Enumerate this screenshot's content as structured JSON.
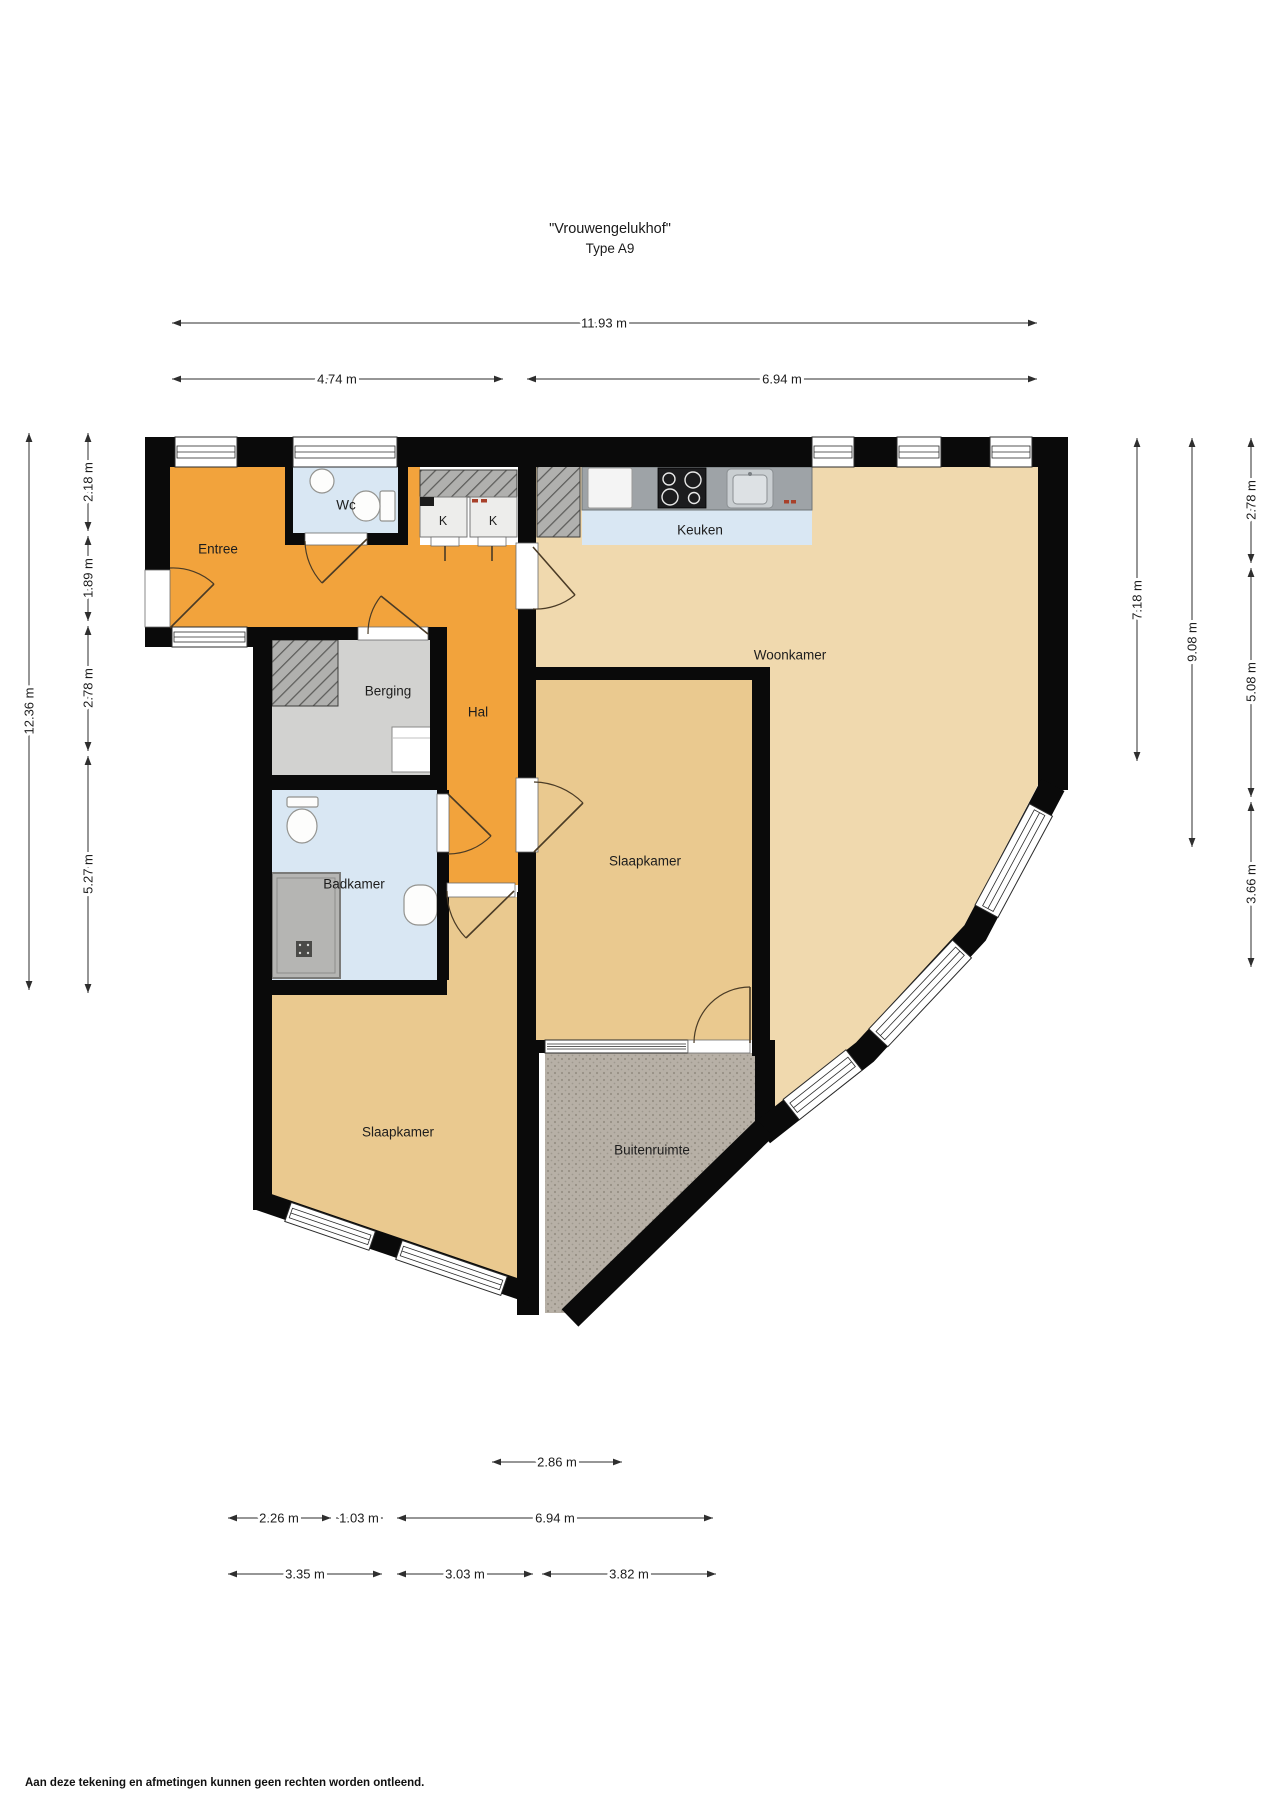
{
  "title": {
    "name": "\"Vrouwengelukhof\"",
    "type": "Type A9"
  },
  "rooms": {
    "entree": "Entree",
    "wc": "Wc",
    "keuken": "Keuken",
    "woonkamer": "Woonkamer",
    "berging": "Berging",
    "hal": "Hal",
    "slaapkamer_middle": "Slaapkamer",
    "badkamer": "Badkamer",
    "slaapkamer_left": "Slaapkamer",
    "buitenruimte": "Buitenruimte",
    "closet_left": "K",
    "closet_right": "K"
  },
  "dimensions": {
    "top": {
      "total": "11.93 m",
      "left_section": "4.74 m",
      "right_section": "6.94 m"
    },
    "left": {
      "total": "12.36 m",
      "segments": [
        "2.18 m",
        "1.89 m",
        "2.78 m",
        "5.27 m"
      ]
    },
    "right": {
      "living_depth": "7.18 m",
      "overall_depth": "9.08 m",
      "segments": [
        "2.78 m",
        "5.08 m",
        "3.66 m"
      ]
    },
    "bottom": {
      "balcony_width": "2.86 m",
      "row2": [
        "2.26 m",
        "1.03 m",
        "6.94 m"
      ],
      "row3": [
        "3.35 m",
        "3.03 m",
        "3.82 m"
      ]
    }
  },
  "footer": {
    "disclaimer": "Aan deze tekening en afmetingen kunnen geen rechten worden ontleend."
  },
  "colors": {
    "hall_orange": "#F2A33C",
    "living_tan": "#F0D9AE",
    "bedroom_tan": "#EAC98F",
    "wet_blue": "#D9E7F3",
    "storage_grey": "#D2D2D0",
    "balcony_grey": "#B7B0A6",
    "wall": "#0A0A0A"
  }
}
